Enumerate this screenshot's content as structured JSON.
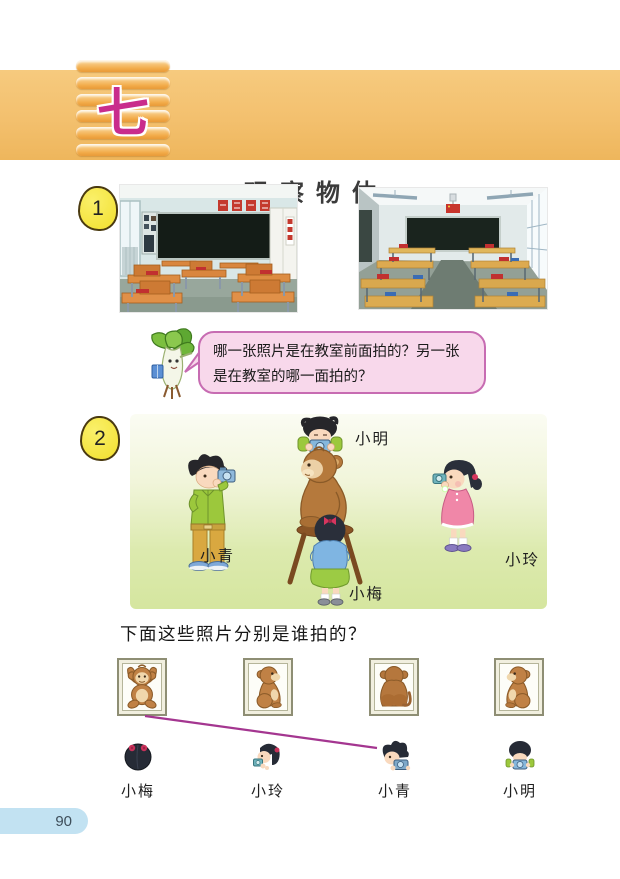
{
  "page": {
    "number": "90"
  },
  "header": {
    "unit_number": "七",
    "title": "观察物体",
    "banner_color": "#f3c06e",
    "unit_color": "#c92c8c"
  },
  "section1": {
    "badge": "1",
    "photo_left_view": "classroom-photo-back-wall",
    "photo_right_view": "classroom-photo-front-wall",
    "speech": {
      "line1": "哪一张照片是在教室前面拍的？另一张",
      "line2": "是在教室的哪一面拍的？"
    }
  },
  "section2": {
    "badge": "2",
    "scene": {
      "left_label": "小青",
      "top_label": "小明",
      "bottom_label": "小梅",
      "right_label": "小玲"
    },
    "question": "下面这些照片分别是谁拍的？",
    "frames": [
      {
        "view": "monkey-front-view"
      },
      {
        "view": "monkey-right-side-view"
      },
      {
        "view": "monkey-back-view"
      },
      {
        "view": "monkey-left-side-view"
      }
    ],
    "children": [
      {
        "name": "小梅"
      },
      {
        "name": "小玲"
      },
      {
        "name": "小青"
      },
      {
        "name": "小明"
      }
    ],
    "answer_line_color": "#a43690"
  }
}
